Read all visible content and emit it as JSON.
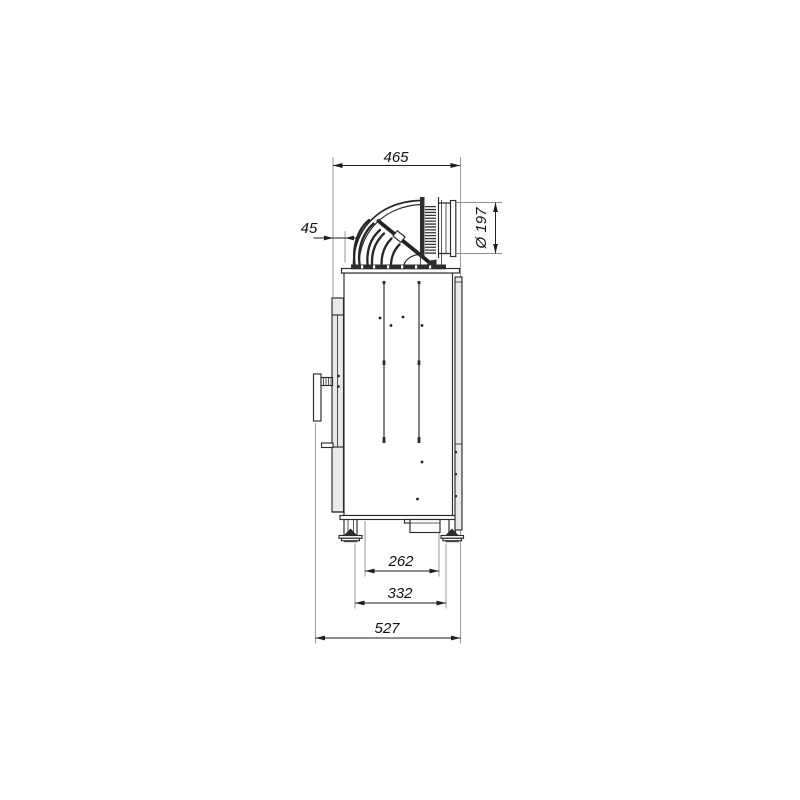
{
  "page": {
    "background": "#ffffff"
  },
  "drawing": {
    "kind": "side-view dimension drawing",
    "dimensions": {
      "top_width": "465",
      "front_offset": "45",
      "flue_diameter": "Ø 197",
      "feet_inner_span": "262",
      "feet_outer_span": "332",
      "total_depth": "527"
    },
    "colors": {
      "outline": "#2a2a2a",
      "dimension_line": "#1e1e1e",
      "extension_line": "#8f8f8f",
      "panel_fill": "#e9e9e9",
      "dark_fill": "#2d2d2d",
      "background": "#ffffff"
    },
    "components": [
      "flue-elbow",
      "corrugated-connector",
      "flue-outlet-pipe",
      "damper-rod",
      "deflector-vanes",
      "top-plate",
      "firebox-body",
      "front-door-frame",
      "door-handle-bracket",
      "rear-heat-shield",
      "interior-guide-rails",
      "air-vent-holes",
      "ash-pan-box",
      "adjustable-feet"
    ]
  }
}
